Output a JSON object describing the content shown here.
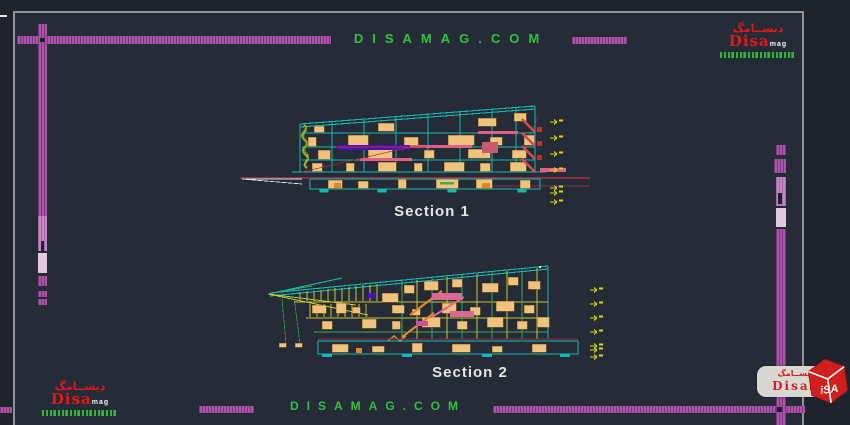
{
  "header": {
    "site_text": "DISAMAG.COM"
  },
  "footer": {
    "site_text": "DISAMAG.COM"
  },
  "logo": {
    "arabic": "ديســامگ",
    "name": "Disa",
    "suffix": "mag"
  },
  "watermark": {
    "arabic": "ديســامگ",
    "name": "Disa",
    "suffix": "mag",
    "cube_text": "iSA"
  },
  "sections": [
    {
      "label": "Section 1"
    },
    {
      "label": "Section 2"
    }
  ],
  "colors": {
    "background": "#252c38",
    "margin_background": "#1f242c",
    "frame_gray": "#8f9298",
    "ruler_magenta": "#aa54aa",
    "site_green": "#2fc23a",
    "logo_red": "#e01818",
    "drawing_cyan": "#17b9ae",
    "drawing_tan": "#efc27e",
    "drawing_pink": "#e0608a",
    "drawing_purple": "#4812c4",
    "drawing_yellow": "#d8d818",
    "ground_maroon": "#8a3142",
    "label_white": "#e4e4e4"
  }
}
